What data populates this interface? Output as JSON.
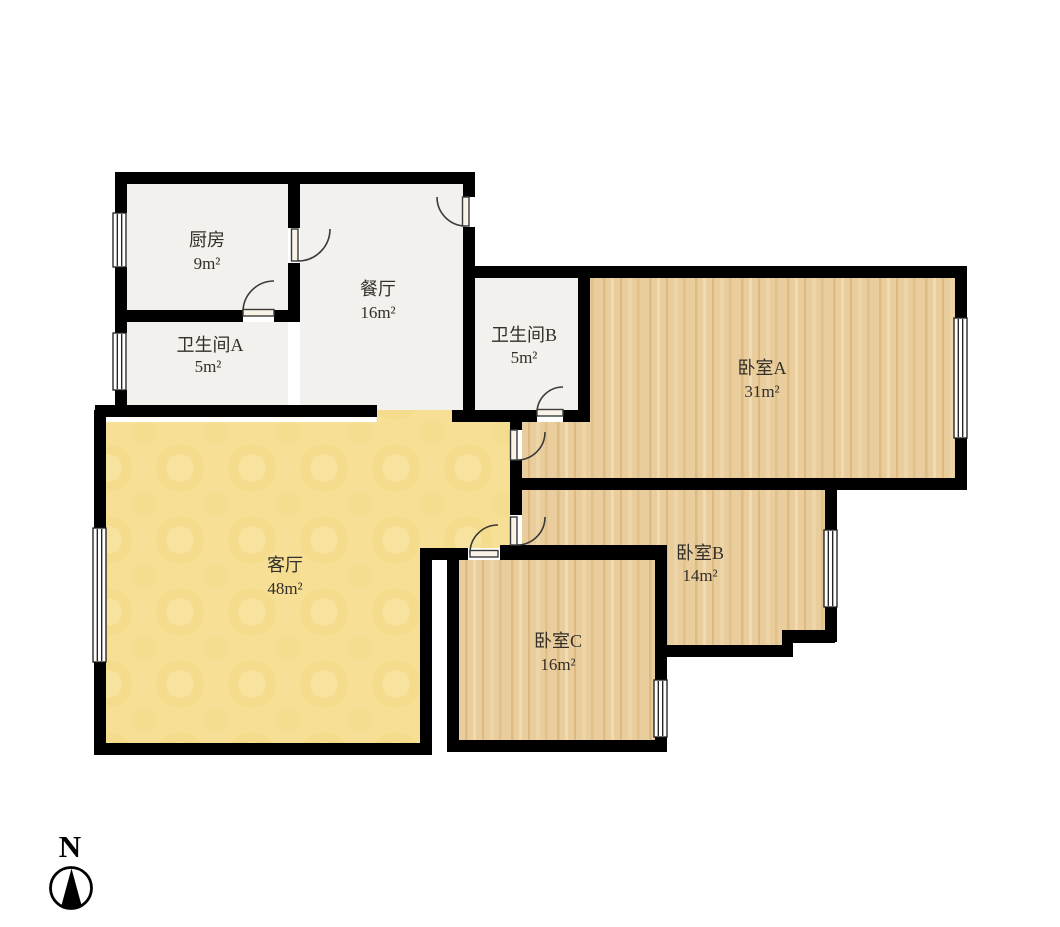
{
  "colors": {
    "background": "#ffffff",
    "wall": "#000000",
    "tile_floor": "#f3f1ed",
    "wood_floor": "#eacd9c",
    "living_floor": "#f7e096",
    "label_text": "#332f2a",
    "door_symbol": "#3a3a3a",
    "window_fill": "#ffffff"
  },
  "compass": {
    "label": "N"
  },
  "rooms": [
    {
      "id": "kitchen",
      "name": "厨房",
      "area": "9m²"
    },
    {
      "id": "bathroom-a",
      "name": "卫生间A",
      "area": "5m²"
    },
    {
      "id": "dining",
      "name": "餐厅",
      "area": "16m²"
    },
    {
      "id": "bathroom-b",
      "name": "卫生间B",
      "area": "5m²"
    },
    {
      "id": "bedroom-a",
      "name": "卧室A",
      "area": "31m²"
    },
    {
      "id": "bedroom-b",
      "name": "卧室B",
      "area": "14m²"
    },
    {
      "id": "bedroom-c",
      "name": "卧室C",
      "area": "16m²"
    },
    {
      "id": "living",
      "name": "客厅",
      "area": "48m²"
    }
  ]
}
